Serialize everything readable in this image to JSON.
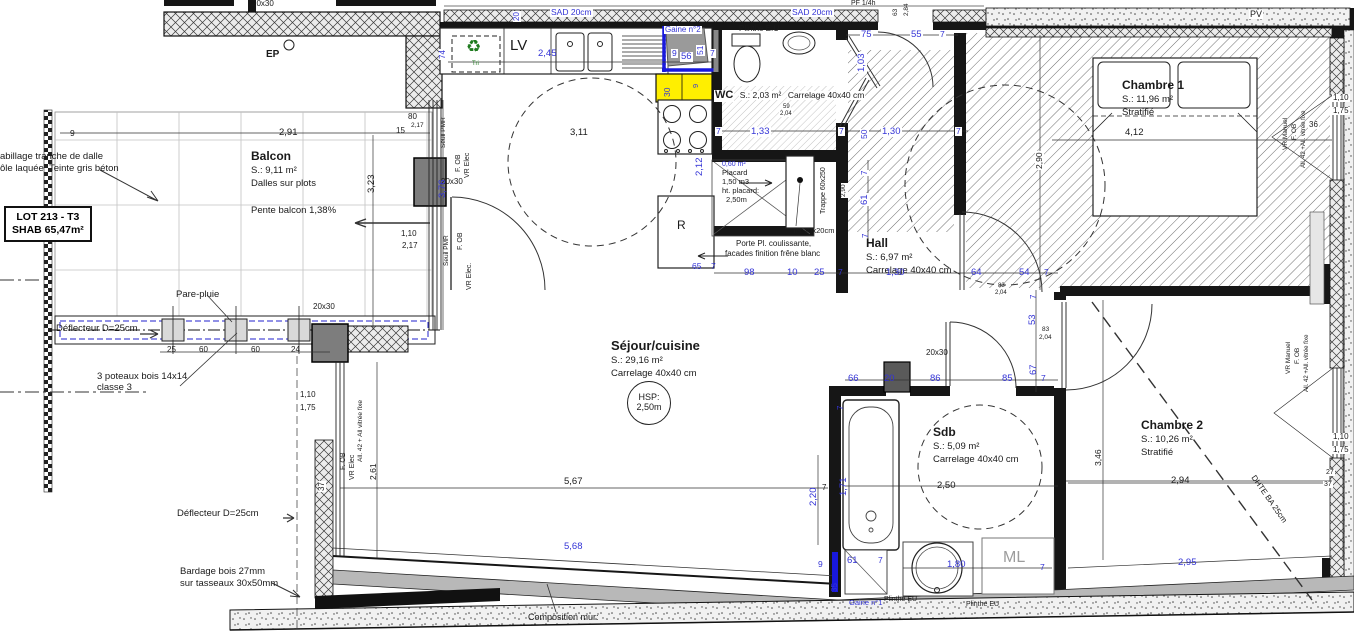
{
  "colors": {
    "dim_blue": "#3434d6",
    "wall_black": "#161616",
    "highlight_yellow": "#ffef00",
    "gaine_blue": "#1818dd",
    "ml_gray": "#9c9c9c",
    "recycle_green": "#1d7a1d"
  },
  "lot_box": {
    "line1": "LOT 213 - T3",
    "line2": "SHAB 65,47m²"
  },
  "rooms": {
    "balcon": {
      "name": "Balcon",
      "area": "S.: 9,11 m²",
      "floor": "Dalles sur plots",
      "note": "Pente balcon 1,38%"
    },
    "sejour": {
      "name": "Séjour/cuisine",
      "area": "S.: 29,16 m²",
      "floor": "Carrelage 40x40 cm",
      "hsp_line1": "HSP:",
      "hsp_line2": "2,50m"
    },
    "wc": {
      "name": "WC",
      "area": "S.: 2,03 m²",
      "floor": "Carrelage 40x40 cm"
    },
    "hall": {
      "name": "Hall",
      "area": "S.: 6,97 m²",
      "floor": "Carrelage 40x40 cm"
    },
    "chambre1": {
      "name": "Chambre 1",
      "area": "S.: 11,96 m²",
      "floor": "Stratifié"
    },
    "chambre2": {
      "name": "Chambre 2",
      "area": "S.: 10,26 m²",
      "floor": "Stratifié"
    },
    "sdb": {
      "name": "Sdb",
      "area": "S.: 5,09 m²",
      "floor": "Carrelage 40x40 cm"
    },
    "placard": {
      "area": "0,60 m²",
      "name": "Placard",
      "volume": "1,50 m3",
      "height_label": "ht. placard:",
      "height_value": "2,50m"
    }
  },
  "equipment": {
    "dishwasher": "LV",
    "sorting": "Tri",
    "fridge": "R",
    "washing_machine": "ML",
    "rainwater": "EP",
    "pv": "PV"
  },
  "labels": [
    {
      "t": "abillage tranche de dalle",
      "x": 0,
      "y": 152,
      "n": "note-cladding-1"
    },
    {
      "t": "ôle laquée  Teinte gris béton",
      "x": 0,
      "y": 164,
      "n": "note-cladding-2"
    },
    {
      "t": "Pare-pluie",
      "x": 176,
      "y": 290,
      "n": "note-pare-pluie"
    },
    {
      "t": "Déflecteur D=25cm",
      "x": 56,
      "y": 324,
      "n": "note-deflecteur-1"
    },
    {
      "t": "3 poteaux bois 14x14",
      "x": 97,
      "y": 372,
      "n": "note-poteaux-1"
    },
    {
      "t": "classe 3",
      "x": 97,
      "y": 383,
      "n": "note-poteaux-2"
    },
    {
      "t": "Déflecteur D=25cm",
      "x": 177,
      "y": 509,
      "n": "note-deflecteur-2"
    },
    {
      "t": "Bardage bois 27mm",
      "x": 180,
      "y": 567,
      "n": "note-bardage-1"
    },
    {
      "t": "sur tasseaux 30x50mm",
      "x": 180,
      "y": 579,
      "n": "note-bardage-2"
    },
    {
      "t": "Composition mur:",
      "x": 528,
      "y": 613,
      "s": 9,
      "n": "note-composition-mur"
    },
    {
      "t": "EP",
      "x": 266,
      "y": 50,
      "b": 1,
      "s": 10,
      "n": "label-ep"
    },
    {
      "t": "LV",
      "x": 510,
      "y": 38,
      "s": 15,
      "n": "label-lv"
    },
    {
      "t": "Tri",
      "x": 472,
      "y": 61,
      "s": 6,
      "c": "gr",
      "n": "label-tri"
    },
    {
      "t": "R",
      "x": 677,
      "y": 219,
      "s": 12,
      "n": "label-fridge"
    },
    {
      "t": "ML",
      "x": 1003,
      "y": 550,
      "s": 16,
      "c": "g",
      "n": "label-ml"
    },
    {
      "t": "PV",
      "x": 1249,
      "y": 10,
      "s": 9,
      "h": 1,
      "n": "label-pv"
    },
    {
      "t": "PF 1/4h",
      "x": 851,
      "y": 0,
      "s": 7,
      "n": "label-pf14h"
    },
    {
      "t": "Plinthe E.U",
      "x": 739,
      "y": 25,
      "s": 8,
      "n": "label-plinthe-eu-1"
    },
    {
      "t": "Plinthe EU",
      "x": 884,
      "y": 596,
      "s": 7,
      "n": "label-plinthe-eu-2"
    },
    {
      "t": "Plinthe EU",
      "x": 966,
      "y": 601,
      "s": 7,
      "n": "label-plinthe-eu-3"
    },
    {
      "t": "Gaine n°1",
      "x": 849,
      "y": 599,
      "s": 7.5,
      "c": "u",
      "n": "label-gaine-1"
    },
    {
      "t": "Gaine n°2",
      "x": 664,
      "y": 26,
      "s": 8,
      "c": "u",
      "h": 1,
      "n": "label-gaine-2"
    },
    {
      "t": "SAD 20cm",
      "x": 550,
      "y": 8,
      "s": 8.5,
      "c": "u",
      "h": 1,
      "n": "label-sad-1"
    },
    {
      "t": "SAD 20cm",
      "x": 791,
      "y": 8,
      "s": 8.5,
      "c": "u",
      "h": 1,
      "n": "label-sad-2"
    },
    {
      "t": "20x30",
      "x": 252,
      "y": 0,
      "s": 8,
      "n": "label-post-size"
    },
    {
      "t": "20x30",
      "x": 441,
      "y": 178,
      "s": 8,
      "n": "label-post-size"
    },
    {
      "t": "20x30",
      "x": 313,
      "y": 303,
      "s": 8,
      "n": "label-post-size"
    },
    {
      "t": "20x30",
      "x": 926,
      "y": 349,
      "s": 8,
      "n": "label-post-size"
    },
    {
      "t": "int.10x20cm",
      "x": 794,
      "y": 227,
      "s": 7.5,
      "n": "label-int-duct"
    },
    {
      "t": "Porte Pl. coulissante,",
      "x": 736,
      "y": 240,
      "s": 8,
      "n": "note-porte-placard-1"
    },
    {
      "t": "facades finition frêne blanc",
      "x": 725,
      "y": 250,
      "s": 8,
      "n": "note-porte-placard-2"
    },
    {
      "t": "Trappe 60x250",
      "x": 820,
      "y": 215,
      "s": 7,
      "r": -90,
      "h": 1,
      "n": "label-trappe"
    },
    {
      "t": "DHTE BA 25cm",
      "x": 1256,
      "y": 474,
      "s": 8,
      "r": 55,
      "n": "label-dhte"
    },
    {
      "t": "Seuil PMR",
      "x": 441,
      "y": 148,
      "r": -90,
      "s": 6.5,
      "n": "label-window"
    },
    {
      "t": "F. OB",
      "x": 455,
      "y": 172,
      "r": -90,
      "s": 7,
      "n": "label-window"
    },
    {
      "t": "VR Elec",
      "x": 464,
      "y": 178,
      "r": -90,
      "s": 7,
      "n": "label-window"
    },
    {
      "t": "Seuil PMR",
      "x": 444,
      "y": 266,
      "r": -90,
      "s": 6.5,
      "n": "label-window"
    },
    {
      "t": "F. OB",
      "x": 457,
      "y": 250,
      "r": -90,
      "s": 7,
      "n": "label-window"
    },
    {
      "t": "VR Elec.",
      "x": 466,
      "y": 290,
      "r": -90,
      "s": 7,
      "n": "label-window"
    },
    {
      "t": "F. OB",
      "x": 340,
      "y": 470,
      "r": -90,
      "s": 7,
      "n": "label-window"
    },
    {
      "t": "VR Elec",
      "x": 349,
      "y": 480,
      "r": -90,
      "s": 7,
      "n": "label-window"
    },
    {
      "t": "All. 42 + All vitrée fixe",
      "x": 358,
      "y": 462,
      "r": -90,
      "s": 6.5,
      "n": "label-window"
    },
    {
      "t": "VR Manuel",
      "x": 1283,
      "y": 150,
      "r": -90,
      "s": 6.5,
      "n": "label-window"
    },
    {
      "t": "F. OB",
      "x": 1292,
      "y": 140,
      "r": -90,
      "s": 6.5,
      "n": "label-window"
    },
    {
      "t": "All. 42 +All. vitrée fixe",
      "x": 1301,
      "y": 168,
      "r": -90,
      "s": 6,
      "n": "label-window"
    },
    {
      "t": "VR Manuel",
      "x": 1286,
      "y": 374,
      "r": -90,
      "s": 6.5,
      "n": "label-window"
    },
    {
      "t": "F. OB",
      "x": 1295,
      "y": 364,
      "r": -90,
      "s": 6.5,
      "n": "label-window"
    },
    {
      "t": "All. 42 +All. vitrée fixe",
      "x": 1304,
      "y": 392,
      "r": -90,
      "s": 6,
      "n": "label-window"
    },
    {
      "t": "9",
      "x": 70,
      "y": 129,
      "s": 8.5
    },
    {
      "t": "2,91",
      "x": 279,
      "y": 128
    },
    {
      "t": "3,23",
      "x": 367,
      "y": 193,
      "r": -90
    },
    {
      "t": "80",
      "x": 408,
      "y": 113,
      "s": 8
    },
    {
      "t": "15",
      "x": 396,
      "y": 127,
      "s": 8
    },
    {
      "t": "2,17",
      "x": 411,
      "y": 123,
      "s": 6.5
    },
    {
      "t": "1,10",
      "x": 401,
      "y": 230,
      "s": 8
    },
    {
      "t": "2,17",
      "x": 402,
      "y": 242,
      "s": 8
    },
    {
      "t": "25",
      "x": 167,
      "y": 346,
      "s": 8
    },
    {
      "t": "60",
      "x": 199,
      "y": 346,
      "s": 8
    },
    {
      "t": "60",
      "x": 251,
      "y": 346,
      "s": 8
    },
    {
      "t": "24",
      "x": 291,
      "y": 346,
      "s": 8
    },
    {
      "t": "1,10",
      "x": 300,
      "y": 391,
      "s": 8
    },
    {
      "t": "1,75",
      "x": 300,
      "y": 404,
      "s": 8
    },
    {
      "t": "37",
      "x": 318,
      "y": 492,
      "r": -90,
      "s": 8,
      "h": 1
    },
    {
      "t": "2,61",
      "x": 369,
      "y": 480,
      "r": -90,
      "s": 8.5
    },
    {
      "t": "3,11",
      "x": 570,
      "y": 128
    },
    {
      "t": "5,67",
      "x": 564,
      "y": 477
    },
    {
      "t": "2,90",
      "x": 1035,
      "y": 170,
      "r": -90,
      "s": 8.5,
      "h": 1
    },
    {
      "t": "4,12",
      "x": 1125,
      "y": 128
    },
    {
      "t": "2,94",
      "x": 1171,
      "y": 476
    },
    {
      "t": "3,46",
      "x": 1094,
      "y": 466,
      "r": -90,
      "s": 8.5
    },
    {
      "t": "1,10",
      "x": 1332,
      "y": 94,
      "s": 8,
      "h": 1
    },
    {
      "t": "1,75",
      "x": 1332,
      "y": 107,
      "s": 8,
      "h": 1
    },
    {
      "t": "36",
      "x": 1308,
      "y": 121,
      "s": 8,
      "h": 1
    },
    {
      "t": "1,10",
      "x": 1332,
      "y": 433,
      "s": 8,
      "h": 1
    },
    {
      "t": "1,75",
      "x": 1332,
      "y": 446,
      "s": 8,
      "h": 1
    },
    {
      "t": "27",
      "x": 1325,
      "y": 469,
      "s": 7,
      "h": 1
    },
    {
      "t": "37",
      "x": 1323,
      "y": 481,
      "s": 7,
      "h": 1
    },
    {
      "t": "2,50",
      "x": 937,
      "y": 481
    },
    {
      "t": "83",
      "x": 998,
      "y": 283,
      "s": 6
    },
    {
      "t": "2,04",
      "x": 995,
      "y": 290,
      "s": 6
    },
    {
      "t": "83",
      "x": 1042,
      "y": 327,
      "s": 6.5
    },
    {
      "t": "2,04",
      "x": 1039,
      "y": 335,
      "s": 6.5
    },
    {
      "t": "59",
      "x": 782,
      "y": 104,
      "s": 6,
      "h": 1
    },
    {
      "t": "2,04",
      "x": 779,
      "y": 111,
      "s": 6,
      "h": 1
    },
    {
      "t": "63",
      "x": 893,
      "y": 16,
      "r": -90,
      "s": 6.5
    },
    {
      "t": "2,84",
      "x": 904,
      "y": 16,
      "r": -90,
      "s": 6.5
    },
    {
      "t": "2,90",
      "x": 841,
      "y": 198,
      "r": -90,
      "s": 6.5,
      "h": 1
    },
    {
      "t": "7",
      "x": 822,
      "y": 484,
      "s": 8
    },
    {
      "t": "2,45",
      "x": 538,
      "y": 49,
      "c": "u"
    },
    {
      "t": "20",
      "x": 513,
      "y": 22,
      "r": -90,
      "s": 8,
      "c": "u",
      "h": 1
    },
    {
      "t": "74",
      "x": 439,
      "y": 60,
      "r": -90,
      "s": 8,
      "c": "u",
      "h": 1
    },
    {
      "t": "9",
      "x": 671,
      "y": 49,
      "s": 8.5,
      "c": "u",
      "h": 1
    },
    {
      "t": "56",
      "x": 680,
      "y": 52,
      "c": "u",
      "h": 1
    },
    {
      "t": "51",
      "x": 696,
      "y": 56,
      "r": -90,
      "s": 8.5,
      "c": "u",
      "h": 1
    },
    {
      "t": "7",
      "x": 709,
      "y": 49,
      "s": 8.5,
      "c": "u",
      "h": 1
    },
    {
      "t": "30",
      "x": 663,
      "y": 97,
      "r": -90,
      "s": 8.5,
      "c": "u"
    },
    {
      "t": "9",
      "x": 692,
      "y": 88,
      "r": -90,
      "s": 7.5,
      "c": "u"
    },
    {
      "t": "3,76",
      "x": 438,
      "y": 198,
      "r": -90,
      "c": "u"
    },
    {
      "t": "7",
      "x": 715,
      "y": 127,
      "s": 8.5,
      "c": "u",
      "h": 1
    },
    {
      "t": "1,33",
      "x": 750,
      "y": 127,
      "c": "u",
      "h": 1
    },
    {
      "t": "7",
      "x": 838,
      "y": 127,
      "s": 8.5,
      "c": "u",
      "h": 1
    },
    {
      "t": "50",
      "x": 860,
      "y": 140,
      "r": -90,
      "s": 8.5,
      "c": "u",
      "h": 1
    },
    {
      "t": "1,30",
      "x": 881,
      "y": 127,
      "c": "u",
      "h": 1
    },
    {
      "t": "7",
      "x": 955,
      "y": 127,
      "s": 8.5,
      "c": "u",
      "h": 1
    },
    {
      "t": "75",
      "x": 860,
      "y": 30,
      "c": "u",
      "h": 1
    },
    {
      "t": "55",
      "x": 910,
      "y": 30,
      "c": "u",
      "h": 1
    },
    {
      "t": "7",
      "x": 939,
      "y": 30,
      "s": 8.5,
      "c": "u",
      "h": 1
    },
    {
      "t": "1,03",
      "x": 857,
      "y": 73,
      "r": -90,
      "c": "u",
      "h": 1
    },
    {
      "t": "2,12",
      "x": 695,
      "y": 176,
      "r": -90,
      "c": "u"
    },
    {
      "t": "65",
      "x": 692,
      "y": 262,
      "s": 8.5,
      "c": "u"
    },
    {
      "t": "7",
      "x": 711,
      "y": 262,
      "s": 8.5,
      "c": "u"
    },
    {
      "t": "98",
      "x": 744,
      "y": 268,
      "c": "u"
    },
    {
      "t": "10",
      "x": 787,
      "y": 268,
      "c": "u"
    },
    {
      "t": "25",
      "x": 814,
      "y": 268,
      "c": "u"
    },
    {
      "t": "7",
      "x": 838,
      "y": 268,
      "s": 8.5,
      "c": "u"
    },
    {
      "t": "1,30",
      "x": 886,
      "y": 268,
      "c": "u"
    },
    {
      "t": "64",
      "x": 971,
      "y": 268,
      "c": "u"
    },
    {
      "t": "54",
      "x": 1019,
      "y": 268,
      "c": "u"
    },
    {
      "t": "7",
      "x": 1044,
      "y": 268,
      "s": 8.5,
      "c": "u"
    },
    {
      "t": "7",
      "x": 861,
      "y": 176,
      "r": -90,
      "s": 8,
      "c": "u",
      "h": 1
    },
    {
      "t": "61",
      "x": 860,
      "y": 206,
      "r": -90,
      "c": "u",
      "h": 1
    },
    {
      "t": "7",
      "x": 862,
      "y": 238,
      "r": -90,
      "s": 8,
      "c": "u"
    },
    {
      "t": "7",
      "x": 1030,
      "y": 299,
      "r": -90,
      "s": 8,
      "c": "u"
    },
    {
      "t": "53",
      "x": 1028,
      "y": 325,
      "r": -90,
      "c": "u"
    },
    {
      "t": "67",
      "x": 1029,
      "y": 375,
      "r": -90,
      "c": "u"
    },
    {
      "t": "66",
      "x": 848,
      "y": 374,
      "c": "u"
    },
    {
      "t": "20",
      "x": 884,
      "y": 374,
      "c": "u"
    },
    {
      "t": "86",
      "x": 930,
      "y": 374,
      "c": "u"
    },
    {
      "t": "85",
      "x": 1002,
      "y": 374,
      "c": "u"
    },
    {
      "t": "7",
      "x": 1041,
      "y": 374,
      "s": 8.5,
      "c": "u"
    },
    {
      "t": "7",
      "x": 837,
      "y": 410,
      "r": -90,
      "s": 8,
      "c": "u"
    },
    {
      "t": "1,71",
      "x": 839,
      "y": 496,
      "r": -90,
      "c": "u"
    },
    {
      "t": "2,20",
      "x": 809,
      "y": 506,
      "r": -90,
      "c": "u"
    },
    {
      "t": "1,80",
      "x": 947,
      "y": 560,
      "c": "u"
    },
    {
      "t": "7",
      "x": 1040,
      "y": 563,
      "s": 8.5,
      "c": "u"
    },
    {
      "t": "9",
      "x": 818,
      "y": 560,
      "s": 8.5,
      "c": "u"
    },
    {
      "t": "61",
      "x": 847,
      "y": 556,
      "c": "u"
    },
    {
      "t": "7",
      "x": 878,
      "y": 556,
      "s": 8.5,
      "c": "u"
    },
    {
      "t": "35",
      "x": 831,
      "y": 592,
      "r": -90,
      "s": 8,
      "c": "u"
    },
    {
      "t": "5,68",
      "x": 564,
      "y": 542,
      "c": "u"
    },
    {
      "t": "2,95",
      "x": 1178,
      "y": 558,
      "c": "u"
    }
  ]
}
